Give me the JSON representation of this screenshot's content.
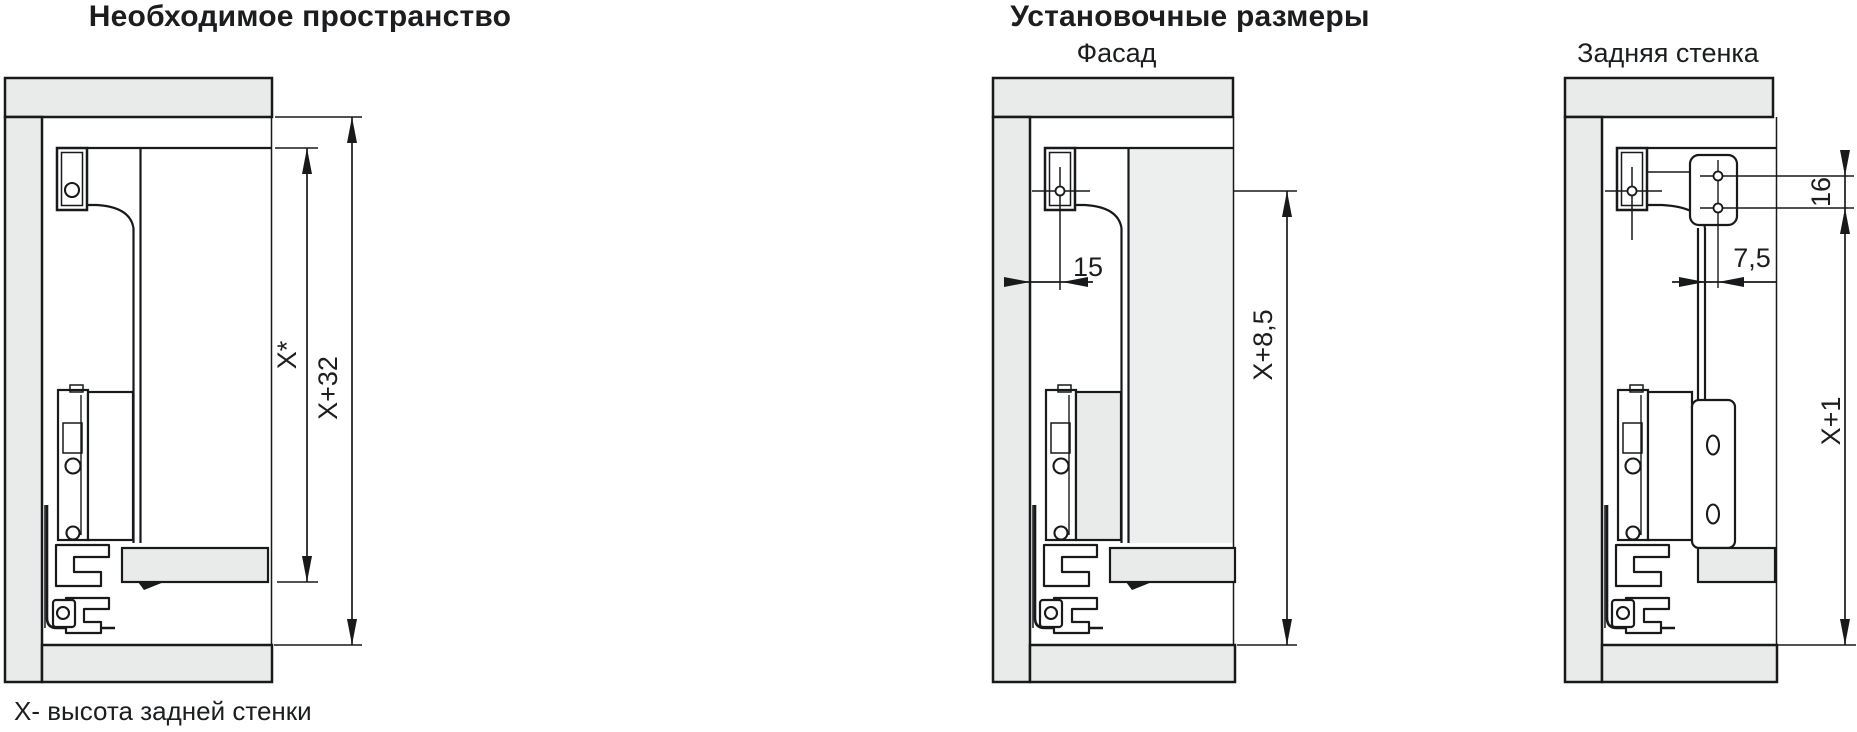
{
  "header": {
    "left_title": "Необходимое пространство",
    "right_title": "Установочные размеры"
  },
  "diagrams": {
    "required_space": {
      "dims": {
        "back_height": "X*",
        "space_height": "X+32"
      }
    },
    "facade": {
      "subtitle": "Фасад",
      "dims": {
        "front_gap": "15",
        "facade_height": "X+8,5"
      }
    },
    "back_wall": {
      "subtitle": "Задняя стенка",
      "dims": {
        "hole_spacing": "16",
        "hole_offset": "7,5",
        "back_height": "X+1"
      }
    }
  },
  "footnote": "X- высота задней стенки",
  "colors": {
    "panel_fill": "#e9ebeb",
    "facade_fill": "#edefef",
    "line": "#17191b",
    "text": "#1b1d1f",
    "background": "#ffffff"
  }
}
